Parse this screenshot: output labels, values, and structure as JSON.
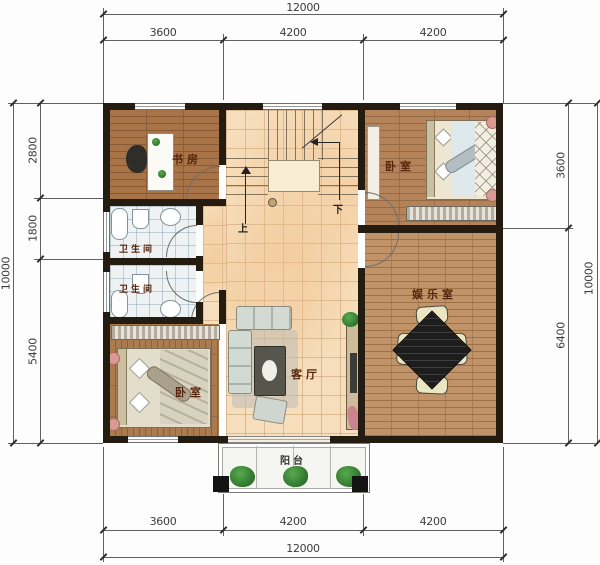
{
  "rooms": {
    "study": "书房",
    "bedroom_top": "卧室",
    "bath1": "卫生间",
    "bath2": "卫生间",
    "bedroom_bottom": "卧室",
    "living": "客厅",
    "entertainment": "娱乐室",
    "balcony": "阳台"
  },
  "stairs": {
    "up": "上",
    "down": "下"
  },
  "dims": {
    "top": {
      "overall": "12000",
      "segs": [
        "3600",
        "4200",
        "4200"
      ]
    },
    "bottom": {
      "overall": "12000",
      "segs": [
        "3600",
        "4200",
        "4200"
      ]
    },
    "left": {
      "overall": "10000",
      "segs": [
        "2800",
        "1800",
        "5400"
      ]
    },
    "right": {
      "overall": "10000",
      "segs": [
        "3600",
        "6400"
      ]
    }
  },
  "colors": {
    "wall": "#241b11",
    "hall_tile": "#f6debc",
    "wood": "#b4835a",
    "bath_tile": "#eef2f3",
    "plant": "#2f7d32",
    "dimension_line": "#606060"
  }
}
